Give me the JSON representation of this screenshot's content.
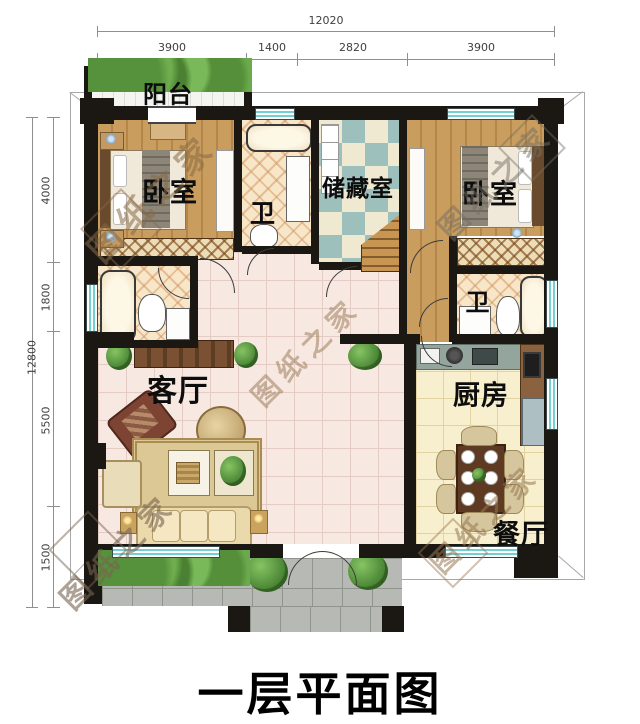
{
  "title": "一层平面图",
  "watermark": {
    "text": "图纸之家"
  },
  "dimensions": {
    "top": {
      "total": "12020",
      "segments": [
        "3900",
        "1400",
        "2820",
        "3900"
      ]
    },
    "left": {
      "total": "12800",
      "segments": [
        "4000",
        "1800",
        "5500",
        "1500"
      ]
    }
  },
  "rooms": {
    "balcony": "阳台",
    "bedroom_left": "卧室",
    "bath_top": "卫",
    "storage": "储藏室",
    "bedroom_right": "卧室",
    "bath_right": "卫",
    "living_room": "客厅",
    "kitchen": "厨房",
    "dining": "餐厅"
  },
  "colors": {
    "wall": "#1b1713",
    "wood_floor": "#c99d5e",
    "bath_tile": "#f8e6c9",
    "storage_teal": "#9dc0bd",
    "living_tile": "#f7e9e2",
    "kitchen_tile": "#f7efcd",
    "window_teal": "#74cfd2",
    "plant_green": "#56923c",
    "porch_gray": "#b7bab4"
  }
}
